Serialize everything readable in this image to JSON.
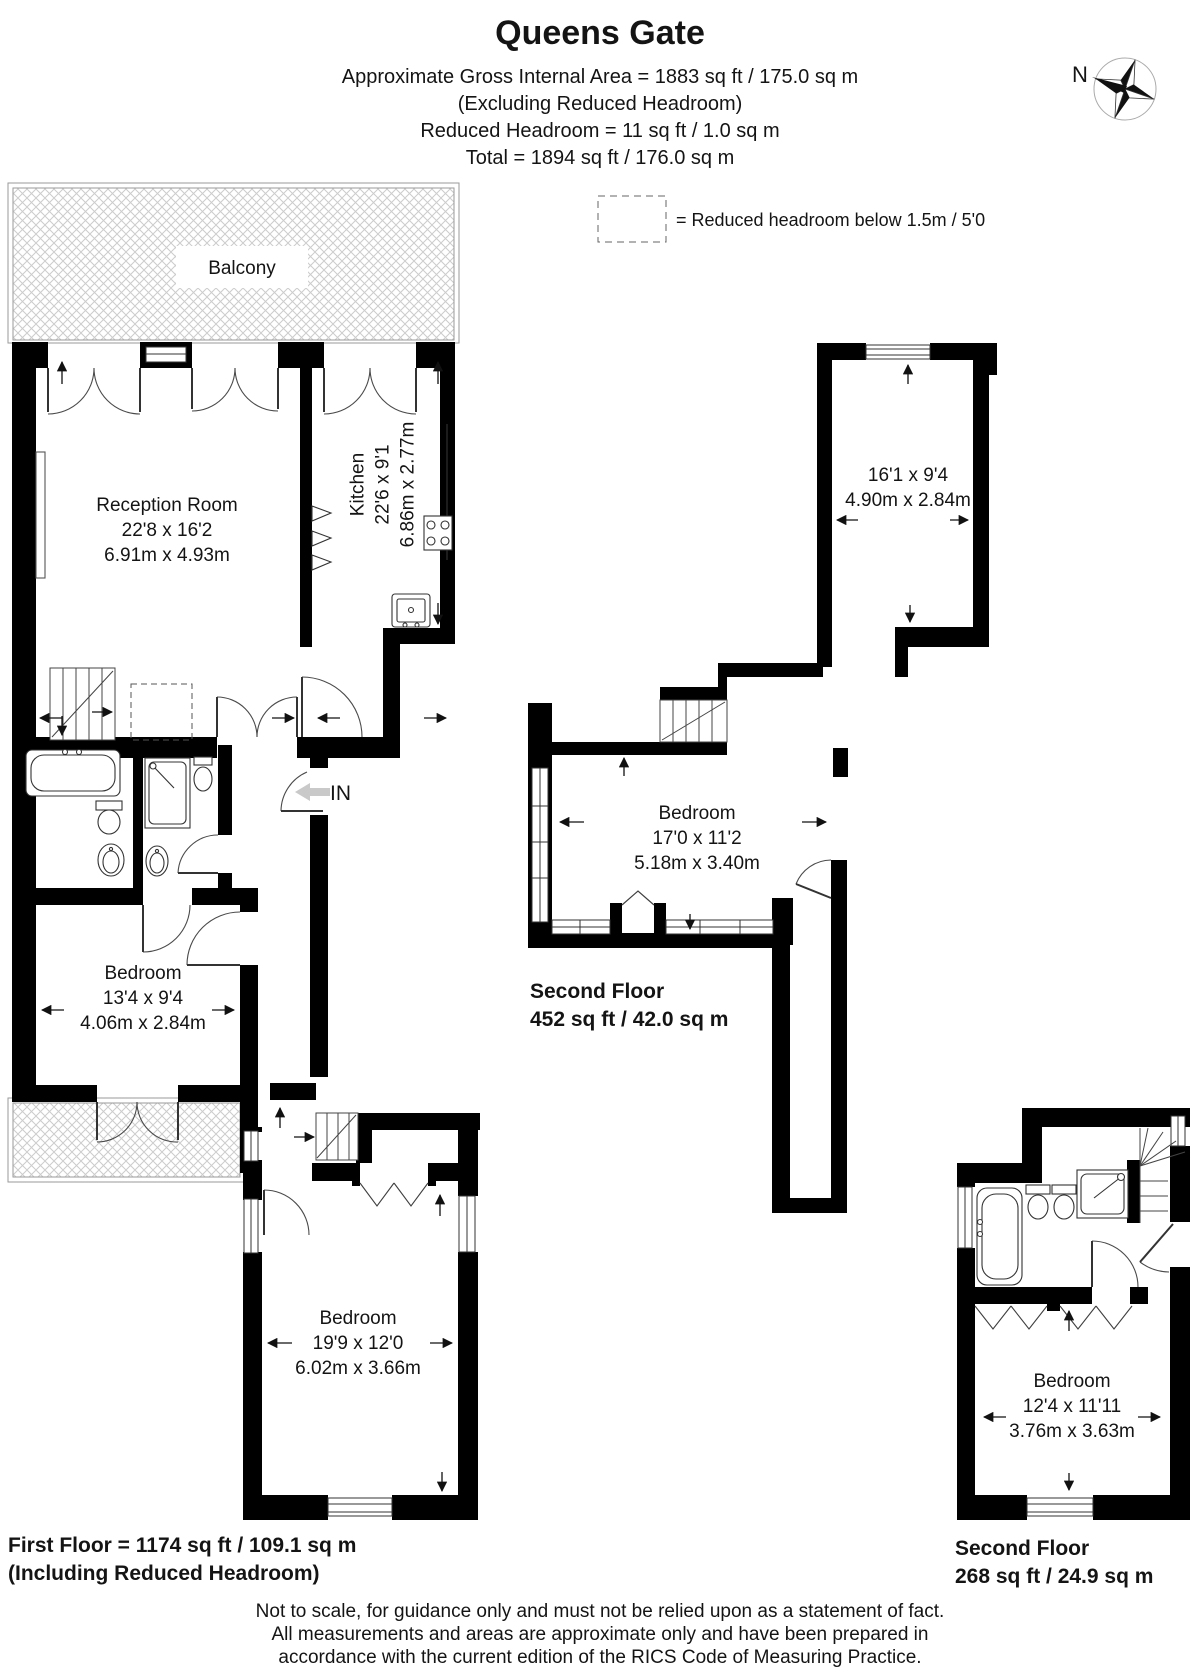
{
  "header": {
    "title": "Queens Gate",
    "line1": "Approximate Gross Internal Area = 1883 sq ft / 175.0 sq m",
    "line2": "(Excluding Reduced Headroom)",
    "line3": "Reduced Headroom = 11 sq ft / 1.0 sq m",
    "line4": "Total = 1894 sq ft / 176.0 sq m"
  },
  "compass": {
    "north": "N"
  },
  "legend": {
    "reduced_headroom": "= Reduced headroom below 1.5m / 5'0"
  },
  "first_floor": {
    "balcony": "Balcony",
    "reception": {
      "name": "Reception Room",
      "imperial": "22'8 x 16'2",
      "metric": "6.91m x 4.93m"
    },
    "kitchen": {
      "name": "Kitchen",
      "imperial": "22'6 x 9'1",
      "metric": "6.86m x 2.77m"
    },
    "entrance": "IN",
    "bedroom1": {
      "name": "Bedroom",
      "imperial": "13'4 x 9'4",
      "metric": "4.06m x 2.84m"
    },
    "bedroom2": {
      "name": "Bedroom",
      "imperial": "19'9 x 12'0",
      "metric": "6.02m x 3.66m"
    },
    "area_line1": "First Floor = 1174 sq ft / 109.1 sq m",
    "area_line2": "(Including Reduced Headroom)"
  },
  "second_floor": {
    "room": {
      "imperial": "16'1 x 9'4",
      "metric": "4.90m x 2.84m"
    },
    "bedroom": {
      "name": "Bedroom",
      "imperial": "17'0 x 11'2",
      "metric": "5.18m x 3.40m"
    },
    "area_line1": "Second Floor",
    "area_line2": "452 sq ft / 42.0 sq m"
  },
  "second_floor_upper": {
    "bedroom": {
      "name": "Bedroom",
      "imperial": "12'4 x 11'11",
      "metric": "3.76m x 3.63m"
    },
    "area_line1": "Second Floor",
    "area_line2": "268 sq ft / 24.9 sq m"
  },
  "footer": {
    "line1": "Not to scale, for guidance only and must not be relied upon as a statement of fact.",
    "line2": "All measurements and areas are approximate only and have been prepared in",
    "line3": "accordance with the current edition of the RICS Code of Measuring Practice."
  },
  "colors": {
    "wall": "#000000",
    "line": "#3f3f3f",
    "hatch": "#cccccc",
    "text": "#141414"
  }
}
